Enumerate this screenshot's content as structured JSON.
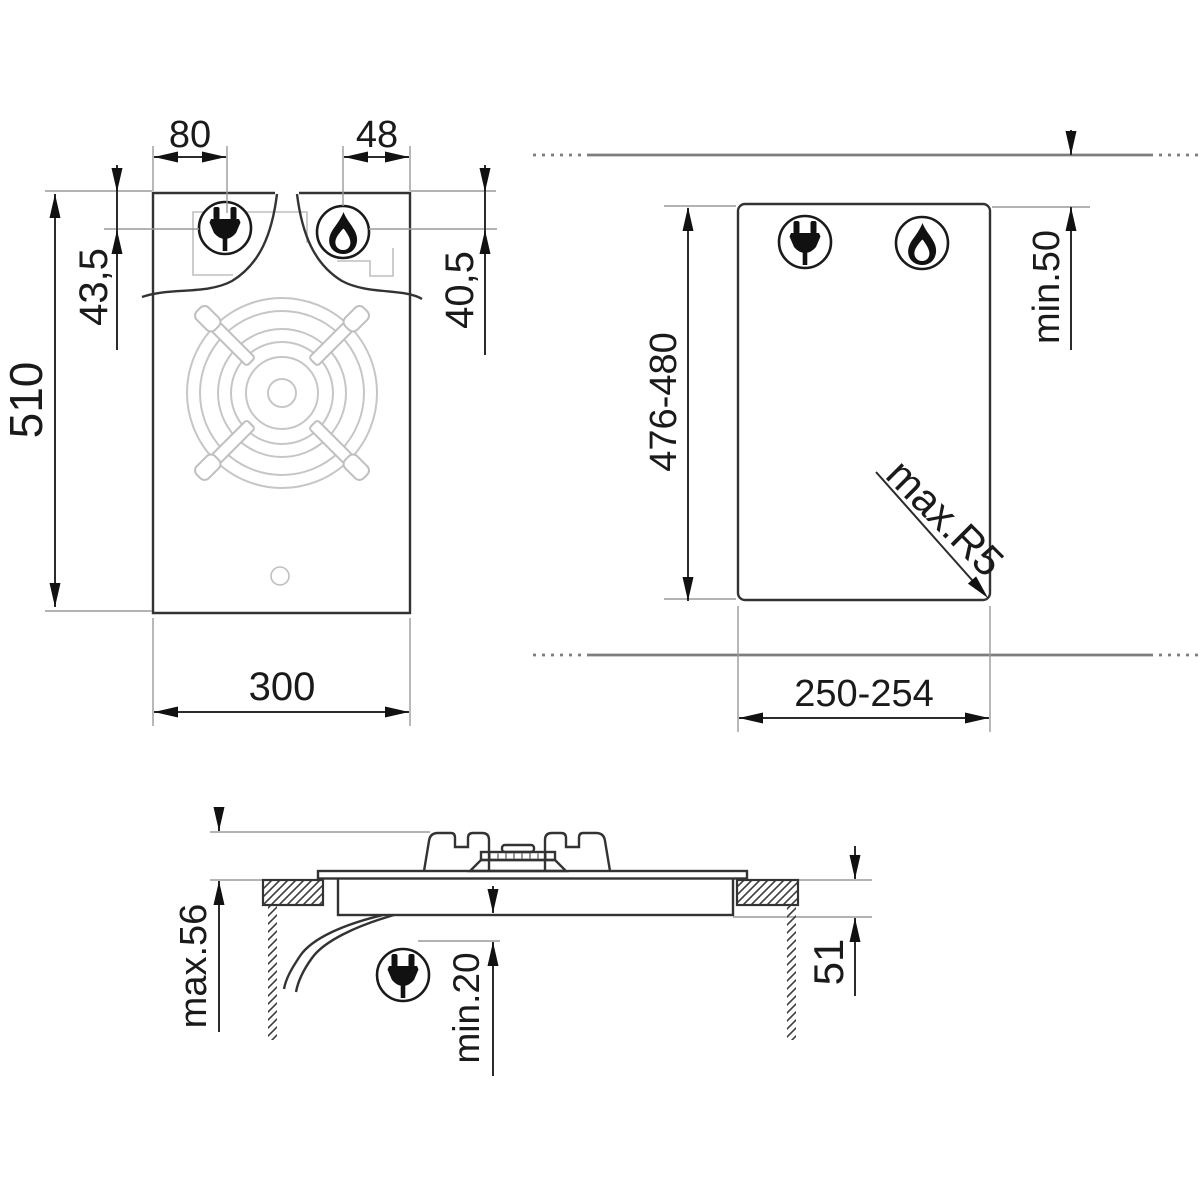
{
  "diagram": {
    "title": "gas-hob-installation-dimensions",
    "front_view": {
      "plug_offset_x": "80",
      "burner_offset_x": "48",
      "plug_offset_y": "43,5",
      "burner_offset_y": "40,5",
      "height": "510",
      "width": "300"
    },
    "cutout_view": {
      "height": "476-480",
      "top_clearance": "min.50",
      "corner_radius": "max.R5",
      "width": "250-254"
    },
    "section_view": {
      "overall_height": "max.56",
      "bottom_clearance": "min.20",
      "recess_depth": "51"
    }
  },
  "icons": {
    "plug": "power-plug-icon",
    "flame": "gas-flame-icon"
  },
  "colors": {
    "outline": "#333333",
    "dimension": "#2b2b2b",
    "reference": "#9a9a9a",
    "hidden_detail": "#bfbfbf",
    "wall_line": "#7d7d7d",
    "icon_fill": "#111111",
    "background": "#ffffff"
  }
}
